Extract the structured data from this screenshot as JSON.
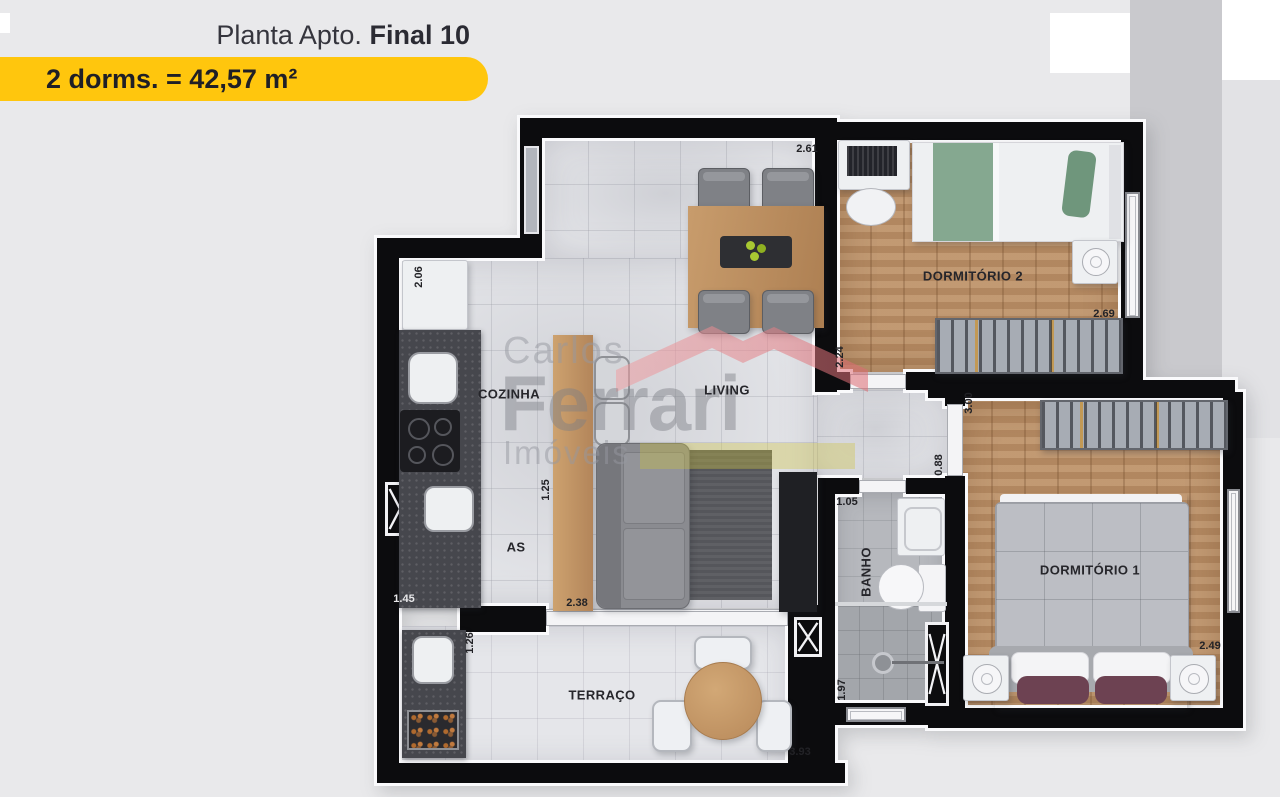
{
  "header": {
    "title_prefix": "Planta Apto.",
    "title_bold": "Final 10",
    "badge": "2 dorms. = 42,57 m²"
  },
  "watermark": {
    "word1": "Carlos",
    "word2": "Ferrari",
    "word3": "Imóveis"
  },
  "rooms": {
    "living": "LIVING",
    "kitchen": "COZINHA",
    "service": "AS",
    "bedroom2": "DORMITÓRIO 2",
    "bedroom1": "DORMITÓRIO 1",
    "bathroom": "BANHO",
    "terrace": "TERRAÇO"
  },
  "dims": {
    "living_top": "2.61",
    "dorm2_left": "2.24",
    "dorm2_bottom": "2.69",
    "dorm1_top": "3.00",
    "hall": "0.88",
    "banho_top": "1.05",
    "kitchen_left": "2.06",
    "kitchen_mid": "1.25",
    "kitchen_bottom": "1.45",
    "living_bottom": "2.38",
    "terrace_left": "1.26",
    "banho_left": "1.97",
    "terrace_bottom": "3.93",
    "dorm1_bottom": "2.49"
  },
  "colors": {
    "accent_yellow": "#ffc60d",
    "wall_black": "#0c0c0e",
    "wood_floor": "#b98e66",
    "logo_pink": "#e2737a",
    "background": "#e9e9eb"
  }
}
